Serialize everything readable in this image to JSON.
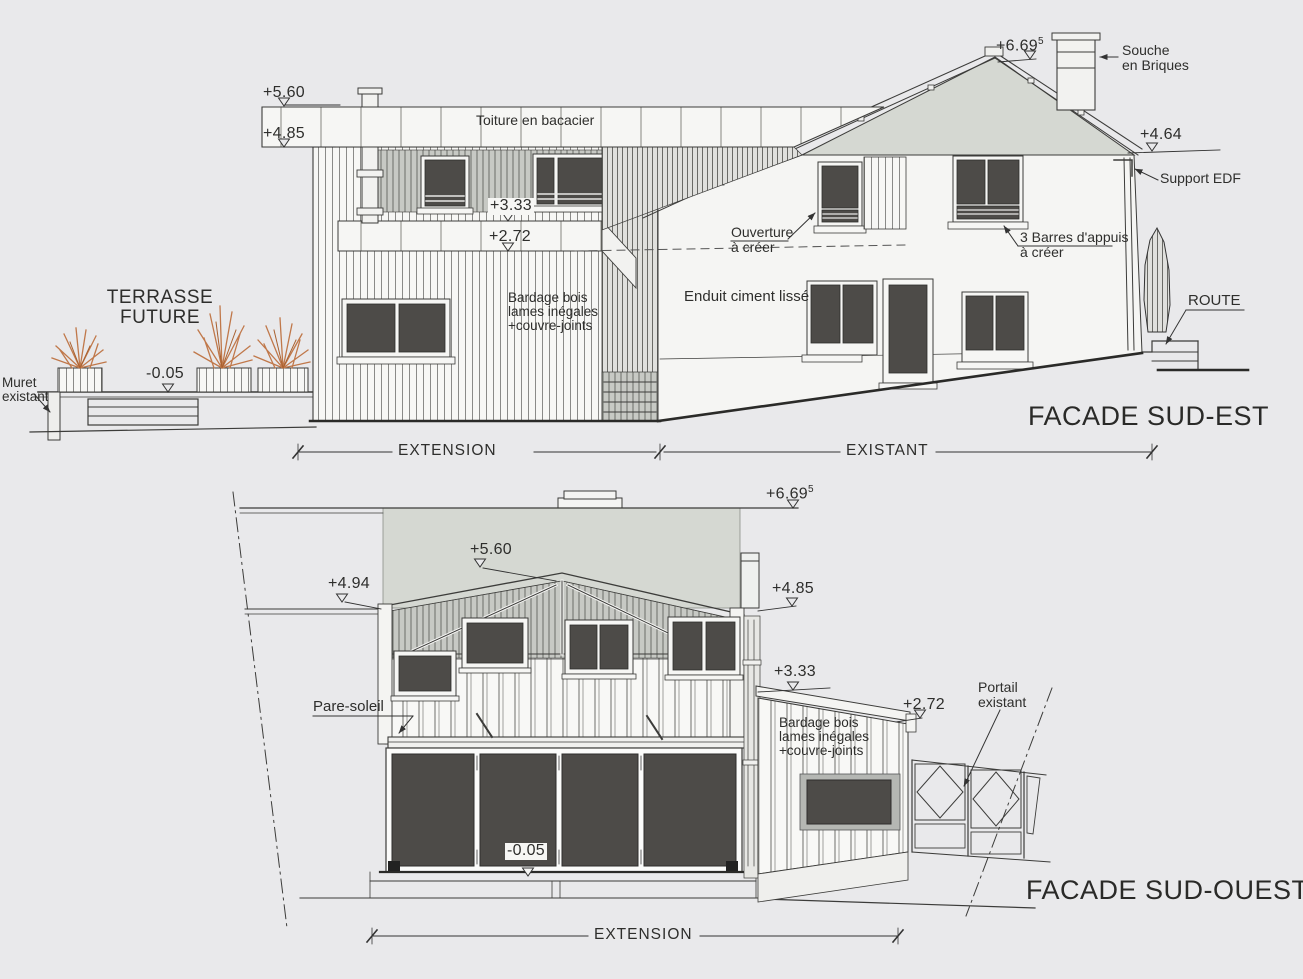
{
  "facade_sud_est": {
    "title": "FACADE SUD-EST",
    "levels": {
      "ridge": "+6.69",
      "ridge_sup": "5",
      "l560": "+5.60",
      "l485": "+4.85",
      "l464": "+4.64",
      "l333": "+3.33",
      "l272": "+2.72",
      "lm005": "-0.05"
    },
    "annotations": {
      "toiture": "Toiture en bacacier",
      "terrasse_l1": "TERRASSE",
      "terrasse_l2": "FUTURE",
      "muret_l1": "Muret",
      "muret_l2": "existant",
      "bardage_l1": "Bardage bois",
      "bardage_l2": "lames inégales",
      "bardage_l3": "+couvre-joints",
      "souche_l1": "Souche",
      "souche_l2": "en Briques",
      "support_edf": "Support EDF",
      "ouverture_l1": "Ouverture",
      "ouverture_l2": "à créer",
      "barres_l1": "3 Barres d'appuis",
      "barres_l2": "à créer",
      "enduit": "Enduit ciment lissé",
      "route": "ROUTE"
    },
    "dimensions": {
      "extension": "EXTENSION",
      "existant": "EXISTANT"
    }
  },
  "facade_sud_ouest": {
    "title": "FACADE SUD-OUEST",
    "levels": {
      "ridge": "+6.69",
      "ridge_sup": "5",
      "l560": "+5.60",
      "l494": "+4.94",
      "l485": "+4.85",
      "l333": "+3.33",
      "l272": "+2.72",
      "lm005": "-0.05"
    },
    "annotations": {
      "pare_soleil": "Pare-soleil",
      "bardage_l1": "Bardage bois",
      "bardage_l2": "lames inégales",
      "bardage_l3": "+couvre-joints",
      "portail_l1": "Portail",
      "portail_l2": "existant"
    },
    "dimensions": {
      "extension": "EXTENSION"
    }
  },
  "colors": {
    "paper": "#e9e9eb",
    "line": "#3c3c3a",
    "roof_fill": "#d5d8d2",
    "glass": "#4d4b48",
    "plant": "#c0784a",
    "shade": "#b7b9b5"
  }
}
